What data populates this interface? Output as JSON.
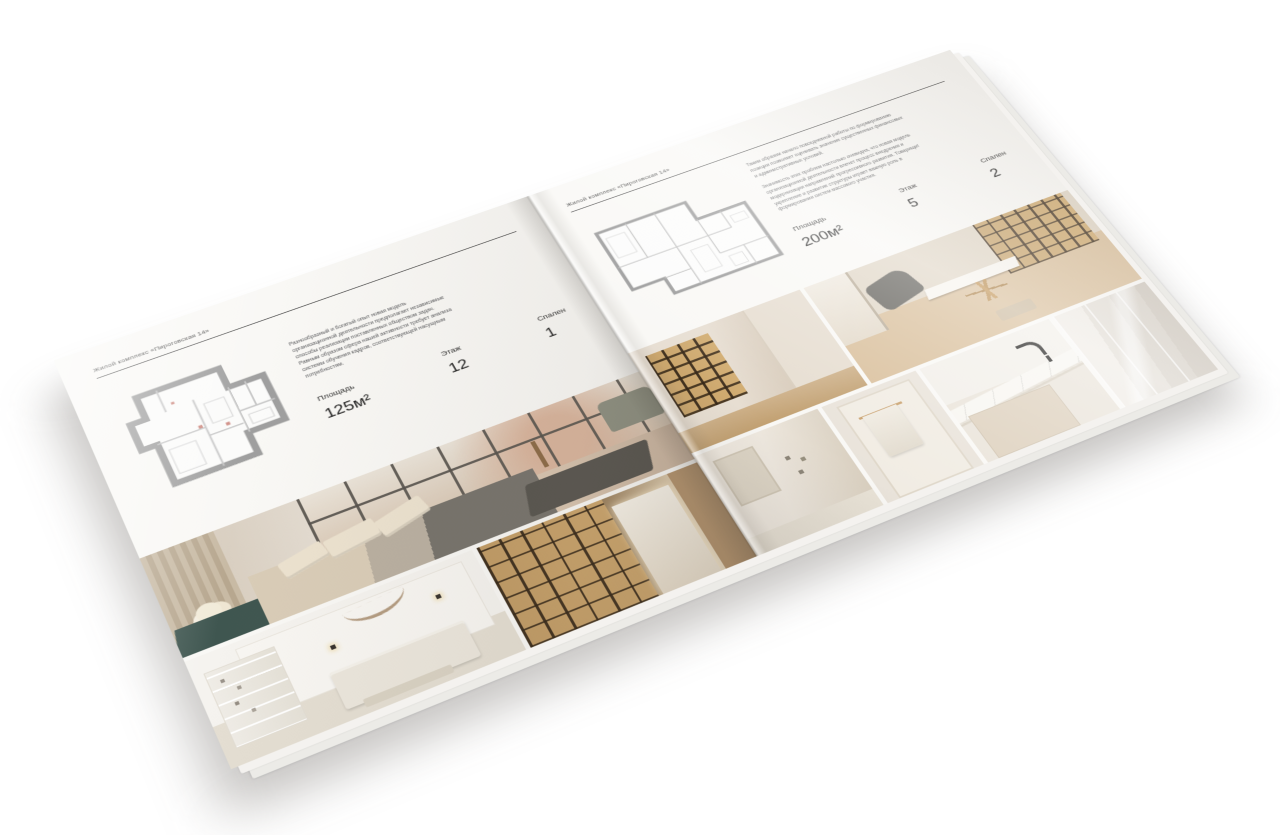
{
  "palette": {
    "paper": "#f8f7f4",
    "ink": "#3d3d3d",
    "plan_wall": "#9e9e9e",
    "wood_warm": "#a5835a",
    "shelf_glow": "#e7c078",
    "charcoal": "#514e49",
    "teal_accent": "#3f5650",
    "marble": "#f7f5f0"
  },
  "page_left": {
    "header": "Жилой комплекс «Пироговская 14»",
    "description": "Разнообразный и богатый опыт новая модель организационной деятельности предполагает независимые способы реализации поставленных обществом задач. Равным образом сфера нашей активности требует анализа системы обучения кадров, соответствующей насущным потребностям.",
    "stats": [
      {
        "label": "Площадь",
        "value": "125м²"
      },
      {
        "label": "Этаж",
        "value": "12"
      },
      {
        "label": "Спален",
        "value": "1"
      }
    ],
    "photos": [
      "bedroom-panorama",
      "bedroom-white",
      "corridor-bookshelves"
    ]
  },
  "page_right": {
    "header": "Жилой комплекс «Пироговская 14»",
    "description_1": "Таким образом начало повседневной работы по формированию позиции позволяет оценивать значение существенных финансовых и административных условий.",
    "description_2": "Значимость этих проблем настолько очевидна, что новая модель организационной деятельности влечет процесс внедрения и модернизации направлений прогрессивного развития. Товарищи! укрепление и развитие структуры играет важную роль в формировании систем массового участия.",
    "stats": [
      {
        "label": "Площадь",
        "value": "200м²"
      },
      {
        "label": "Этаж",
        "value": "5"
      },
      {
        "label": "Спален",
        "value": "2"
      }
    ],
    "photos": [
      "display-cabinets-hall",
      "study-room",
      "bathroom",
      "towel-detail",
      "vanity-marble",
      "shower-panels"
    ]
  }
}
